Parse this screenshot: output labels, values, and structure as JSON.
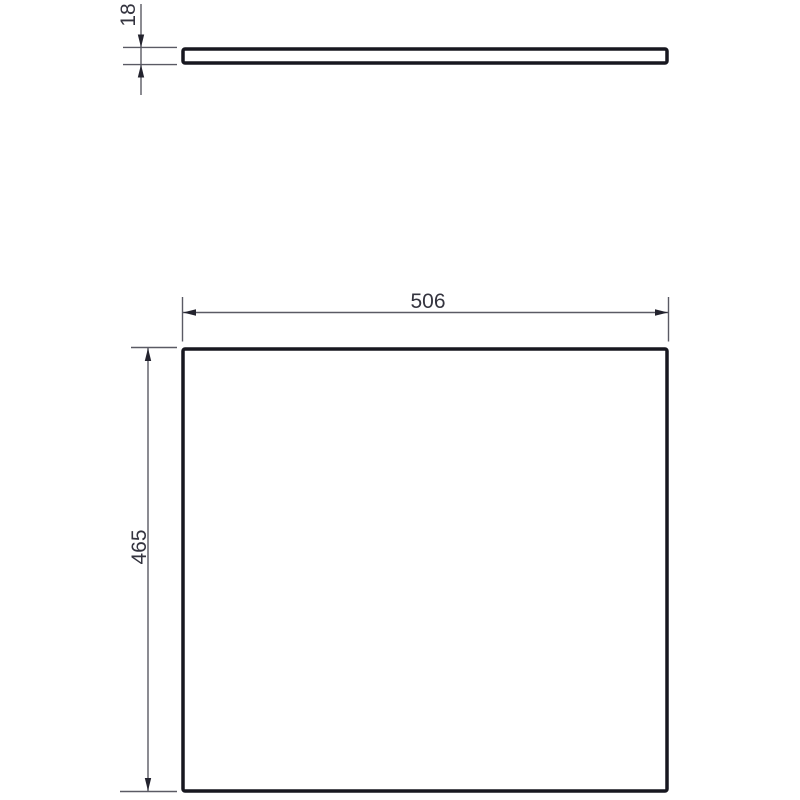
{
  "drawing": {
    "kind": "technical-dimension-drawing",
    "dimensions": {
      "thickness": "18",
      "width": "506",
      "height": "465"
    },
    "views": {
      "side_view": "panel edge profile (top)",
      "front_view": "panel face (bottom)"
    },
    "colors": {
      "background": "#ffffff",
      "part_outline": "#17171f",
      "dimension_lines": "#5a5a64",
      "dimension_text": "#34343f",
      "arrowheads": "#23232e"
    }
  }
}
